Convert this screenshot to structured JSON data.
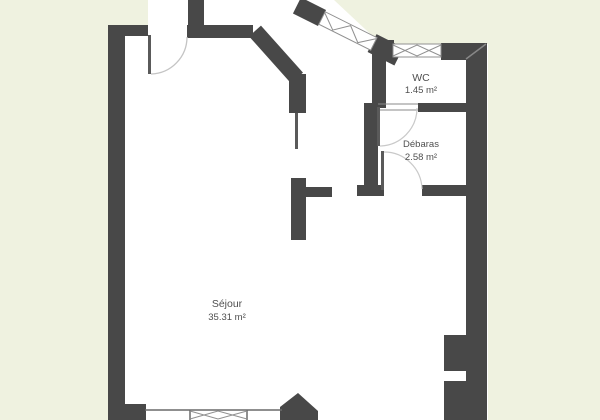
{
  "plan": {
    "type": "floor-plan",
    "rooms": [
      {
        "name": "Séjour",
        "area": "35.31 m²"
      },
      {
        "name": "WC",
        "area": "1.45 m²"
      },
      {
        "name": "Débaras",
        "area": "2.58 m²"
      }
    ],
    "colors": {
      "exterior_background": "#eff2e0",
      "wall": "#484848",
      "floor": "#ffffff",
      "door_arc": "#c4c4c4",
      "window_line": "#909090",
      "label_text": "#4f4f4f"
    }
  }
}
